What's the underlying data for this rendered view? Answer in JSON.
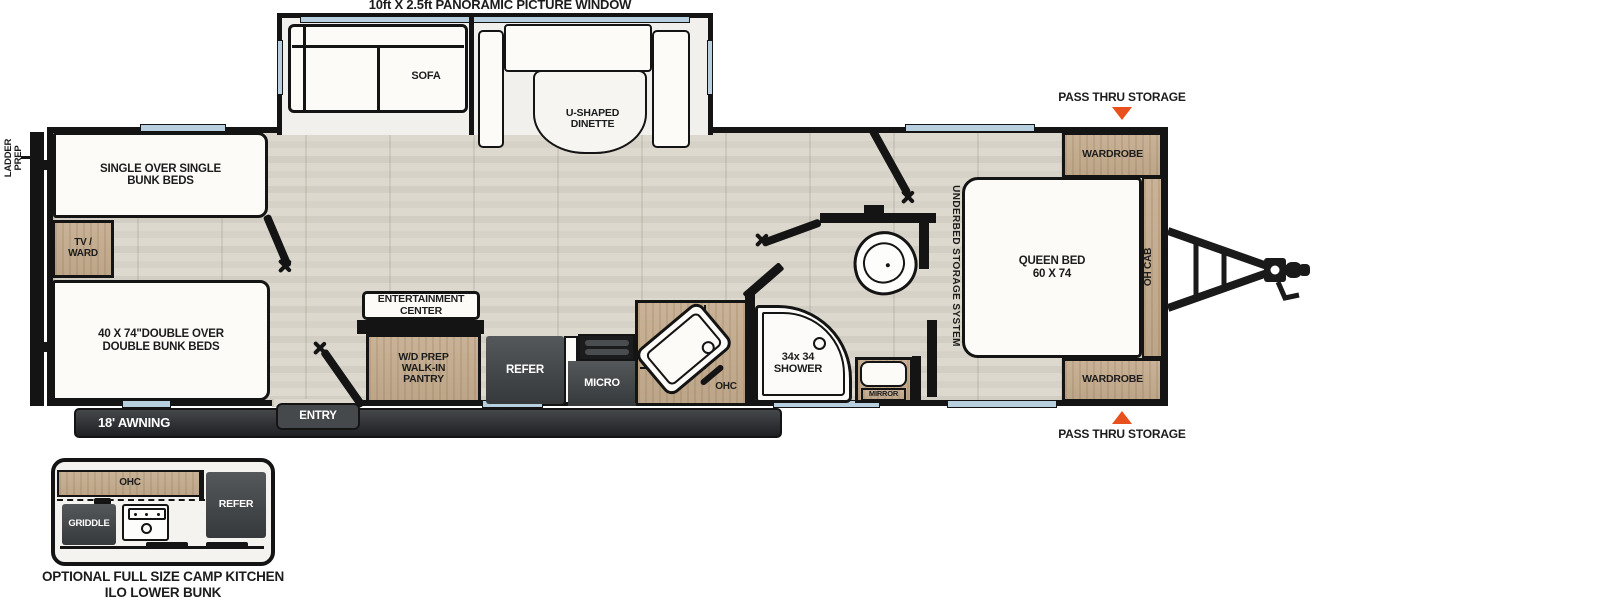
{
  "title": "10ft X 2.5ft PANORAMIC PICTURE WINDOW",
  "colors": {
    "wall": "#141414",
    "floor": "#d9d5cb",
    "cabinet_wood": "#c3ac90",
    "appliance_dark": "#46484a",
    "window_blue": "#b7cfdf",
    "accent_orange": "#e8501e",
    "awning_dark": "#2c2e31"
  },
  "rooms": {
    "slideout": {
      "sofa": "SOFA",
      "dinette": "U-SHAPED\nDINETTE"
    },
    "rear": {
      "ladder_prep": "LADDER\nPREP",
      "single_bunk": "SINGLE OVER SINGLE\nBUNK BEDS",
      "tv_ward": "TV /\nWARD",
      "double_bunk": "40 X 74\"DOUBLE OVER\nDOUBLE BUNK BEDS"
    },
    "kitchen": {
      "entertainment_center": "ENTERTAINMENT\nCENTER",
      "pantry": "W/D PREP\nWALK-IN\nPANTRY",
      "refer": "REFER",
      "micro": "MICRO",
      "ohc": "OHC"
    },
    "bath": {
      "shower": "34x 34\nSHOWER",
      "mirror": "MIRROR"
    },
    "bedroom": {
      "underbed": "UNDERBED STORAGE SYSTEM",
      "queen_bed": "QUEEN BED\n60 X 74",
      "oh_cab": "OH CAB",
      "wardrobe_top": "WARDROBE",
      "wardrobe_bottom": "WARDROBE",
      "pass_thru_top": "PASS THRU STORAGE",
      "pass_thru_bottom": "PASS THRU STORAGE"
    },
    "exterior": {
      "awning": "18' AWNING",
      "entry": "ENTRY"
    }
  },
  "inset": {
    "ohc": "OHC",
    "griddle": "GRIDDLE",
    "refer": "REFER",
    "caption": "OPTIONAL FULL SIZE CAMP KITCHEN\nILO LOWER BUNK"
  }
}
